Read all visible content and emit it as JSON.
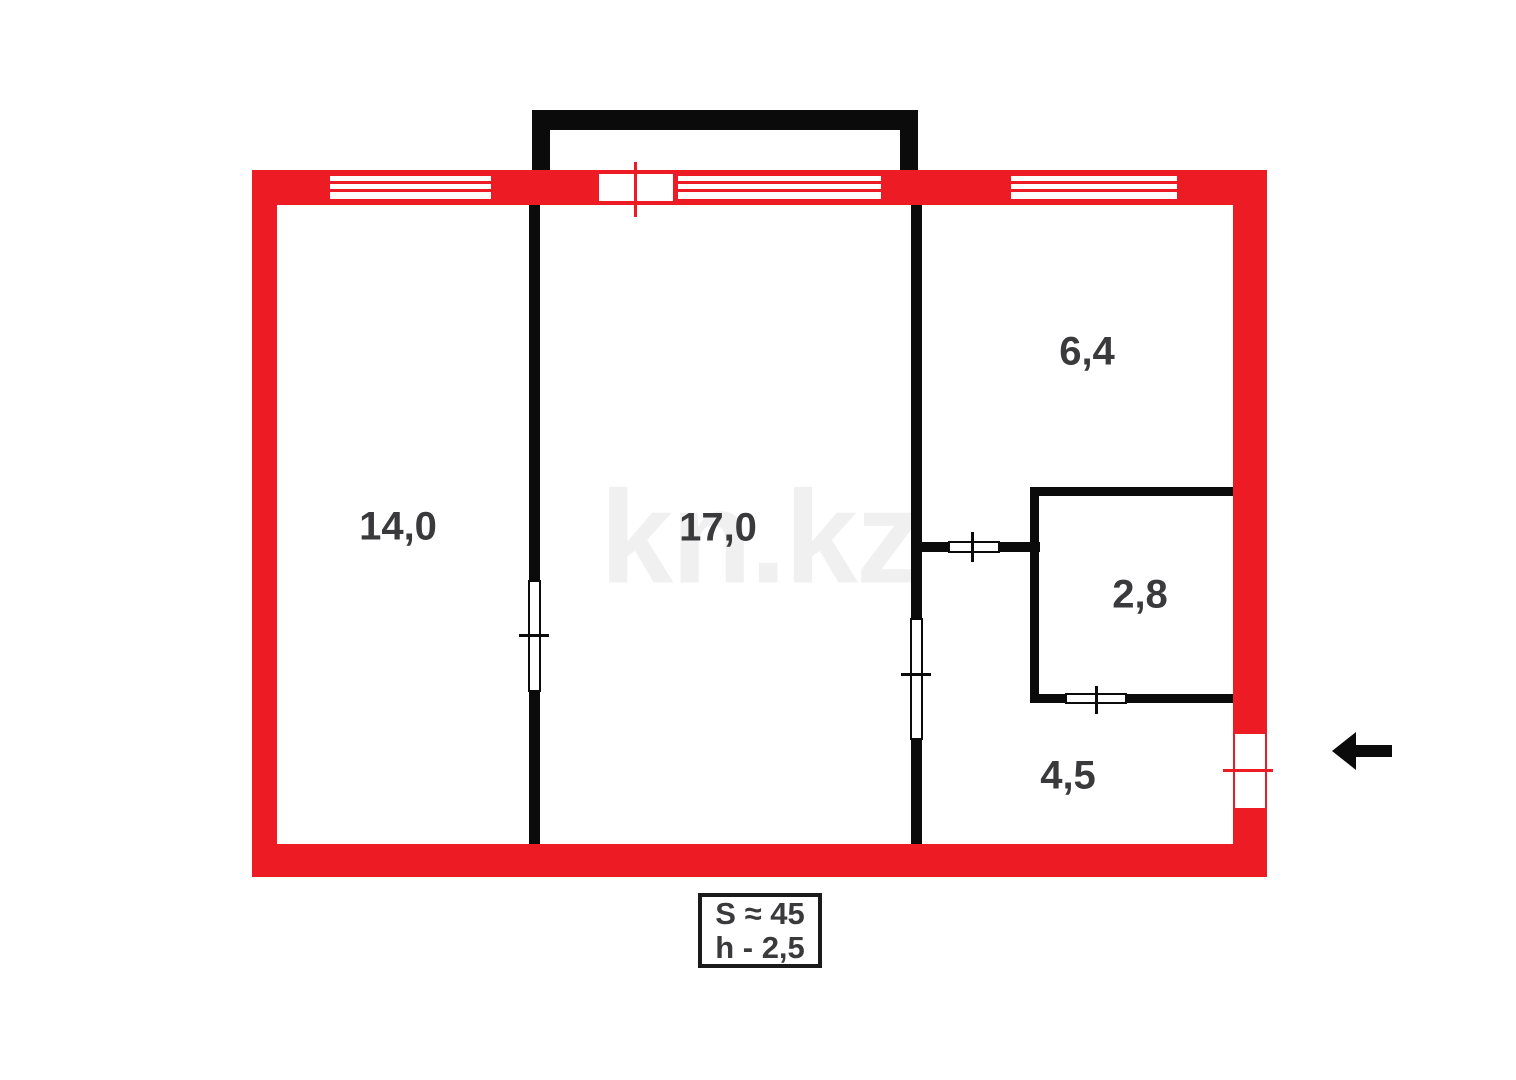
{
  "plan": {
    "watermark": "kn.kz",
    "rooms": [
      {
        "area": "14,0"
      },
      {
        "area": "17,0"
      },
      {
        "area": "6,4"
      },
      {
        "area": "2,8"
      },
      {
        "area": "4,5"
      }
    ],
    "summary": {
      "total_area": "S ≈ 45",
      "ceiling_height": "h - 2,5"
    },
    "colors": {
      "outer_wall_red": "#ED1C24",
      "inner_wall_black": "#0B0B0B",
      "room_label": "#3A3A3C",
      "watermark_gray": "#F0F0F0"
    },
    "icons": {
      "entrance_arrow": "arrow-left-icon"
    }
  }
}
